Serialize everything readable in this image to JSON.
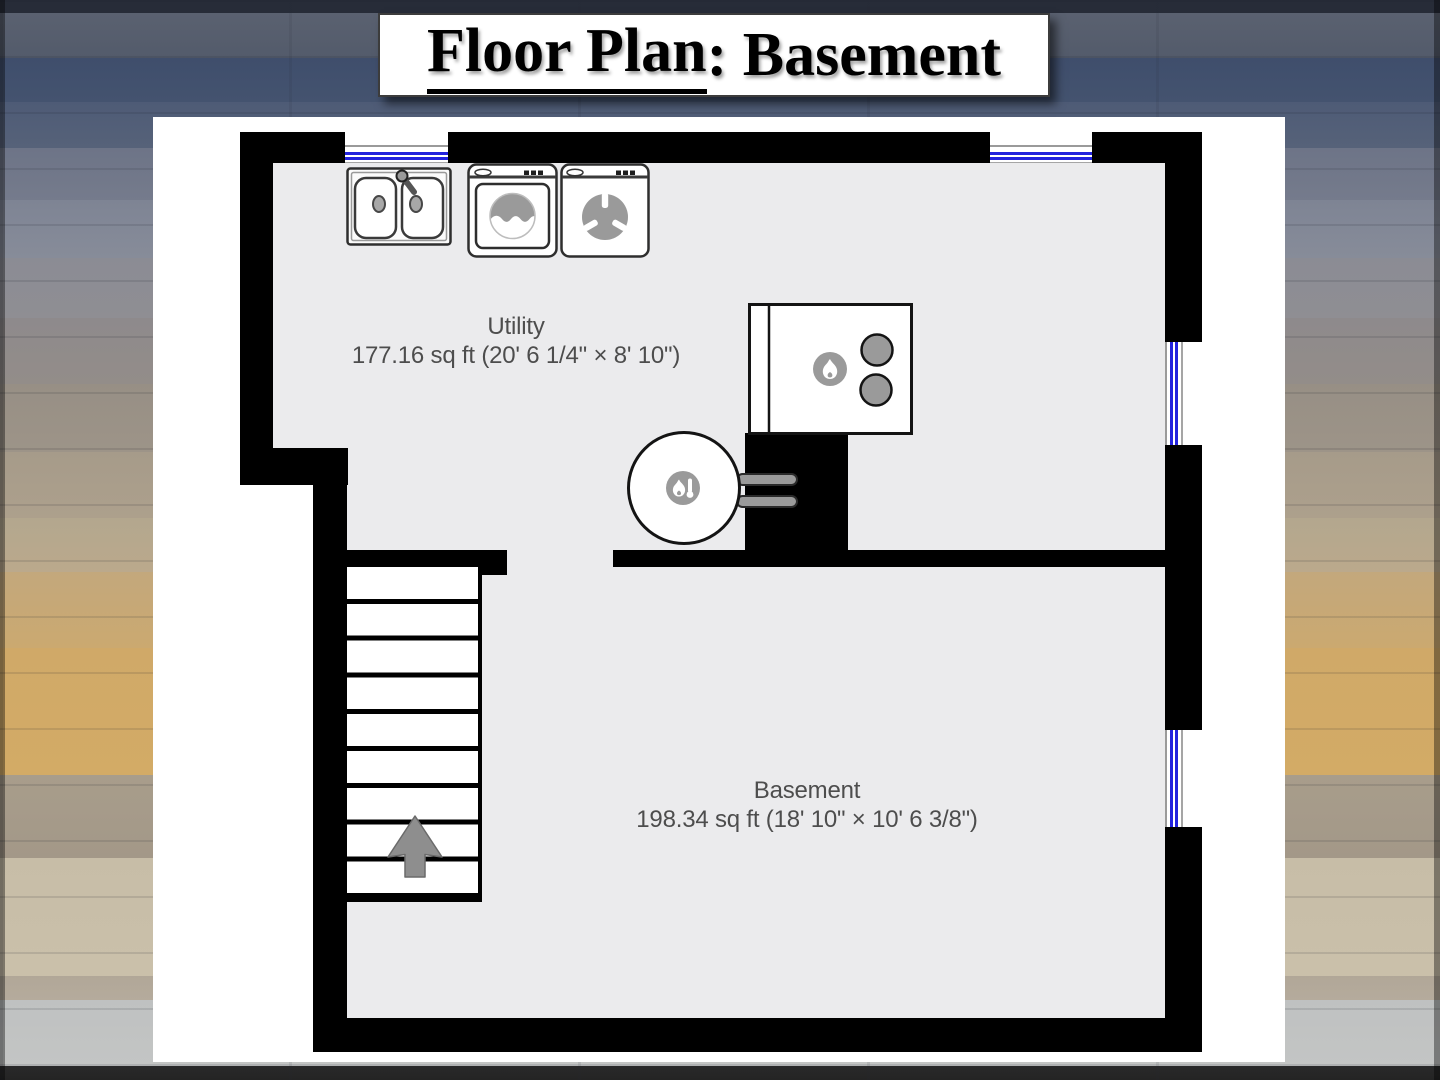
{
  "title": {
    "underlined_part": "Floor Plan",
    "rest_part": ": Basement"
  },
  "rooms": {
    "utility": {
      "name": "Utility",
      "area": "177.16 sq ft (20' 6 1/4\" × 8' 10\")"
    },
    "basement": {
      "name": "Basement",
      "area": "198.34 sq ft (18' 10\" × 10' 6 3/8\")"
    }
  },
  "fixtures": {
    "sink": "double-basin-sink",
    "washer": "washing-machine",
    "dryer": "clothes-dryer",
    "furnace": "furnace-with-burners",
    "water_heater": "gas-water-heater"
  },
  "stairs": {
    "tread_count": 9,
    "arrow_direction": "up"
  },
  "windows": {
    "count": 4
  },
  "colors": {
    "wall": "#000000",
    "floor": "#ebebed",
    "window_blue": "#2222dd",
    "room_label": "#4d4d4d",
    "fixture_icon_gray": "#9a9a9a",
    "page": "#ffffff"
  }
}
